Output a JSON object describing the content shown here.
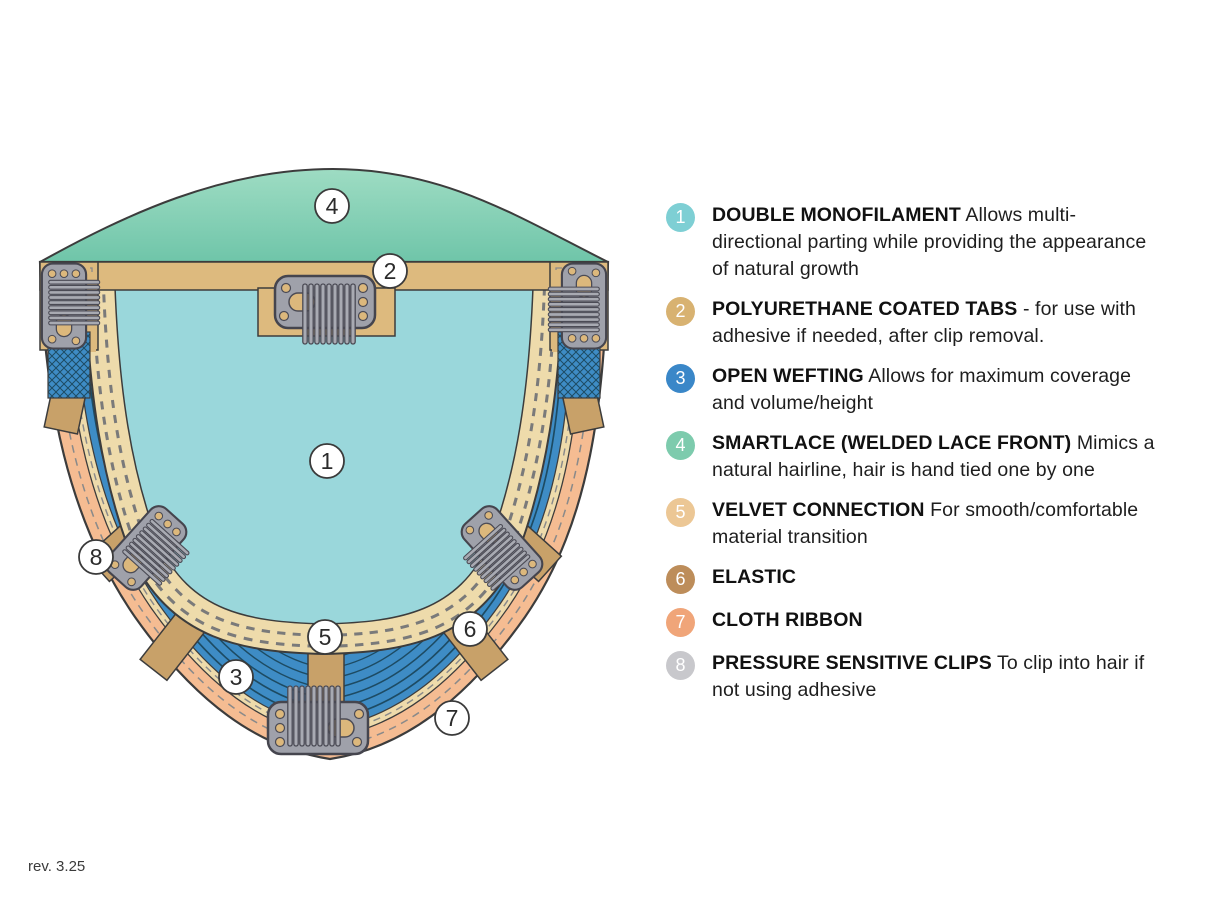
{
  "page": {
    "background": "#ffffff",
    "revision": "rev. 3.25"
  },
  "colors": {
    "lace_top": "#9edcc3",
    "lace_bottom": "#6fc5a9",
    "monofilament": "#9ad7db",
    "weft_blue": "#3e8cc5",
    "weft_line": "#1d4b63",
    "ribbon_peach": "#f5bc92",
    "band_cream": "#eedbab",
    "tab_tan": "#ddba7e",
    "strip_tan": "#c8a169",
    "clip_gray": "#9fa1aa",
    "clip_outline": "#45454e",
    "outline": "#3c3c3c",
    "stitch_dash": "#8a8a8a"
  },
  "legend": {
    "items": [
      {
        "number": "1",
        "color": "#7ecfd4",
        "bold": "DOUBLE MONOFILAMENT",
        "text": "Allows multi-directional parting while providing the appearance of natural growth"
      },
      {
        "number": "2",
        "color": "#d8b271",
        "bold": "POLYURETHANE COATED TABS",
        "text": "- for use with adhesive if needed, after clip removal."
      },
      {
        "number": "3",
        "color": "#3a87c8",
        "bold": "OPEN WEFTING",
        "text": "Allows for maximum coverage and volume/height"
      },
      {
        "number": "4",
        "color": "#7dcbad",
        "bold": "SMARTLACE (WELDED LACE FRONT)",
        "text": "Mimics a natural hairline, hair is hand tied one by one"
      },
      {
        "number": "5",
        "color": "#ecc795",
        "bold": "VELVET CONNECTION",
        "text": "For smooth/comfortable material transition"
      },
      {
        "number": "6",
        "color": "#bd8d5a",
        "bold": "ELASTIC",
        "text": ""
      },
      {
        "number": "7",
        "color": "#f0a579",
        "bold": "CLOTH RIBBON",
        "text": ""
      },
      {
        "number": "8",
        "color": "#c8c8cc",
        "bold": "PRESSURE SENSITIVE CLIPS",
        "text": "To clip into hair if not using adhesive"
      }
    ]
  }
}
